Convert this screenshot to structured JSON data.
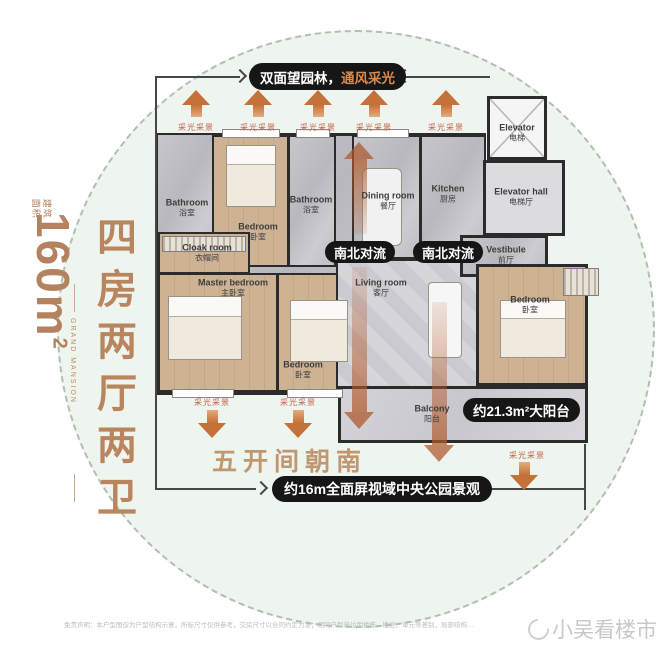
{
  "banner_top": {
    "white": "双面望园林，",
    "orange": "通风采光"
  },
  "side": {
    "area_stamp": "建筑面积",
    "area_value": "160m",
    "area_exp": "2",
    "brand": "GRAND MANSION",
    "headline": "四房两厅两卫"
  },
  "pills": {
    "convection": "南北对流",
    "balcony": "约21.3m²大阳台",
    "view": "约16m全面屏视域中央公园景观"
  },
  "slogan_south": "五开间朝南",
  "light_label": "采光采景",
  "rooms": [
    {
      "en": "Bathroom",
      "cn": "浴室"
    },
    {
      "en": "Bedroom",
      "cn": "卧室"
    },
    {
      "en": "Bathroom",
      "cn": "浴室"
    },
    {
      "en": "Cloak room",
      "cn": "衣帽间"
    },
    {
      "en": "Master bedroom",
      "cn": "主卧室"
    },
    {
      "en": "Bedroom",
      "cn": "卧室"
    },
    {
      "en": "Dining room",
      "cn": "餐厅"
    },
    {
      "en": "Kitchen",
      "cn": "厨房"
    },
    {
      "en": "Elevator",
      "cn": "电梯"
    },
    {
      "en": "Elevator hall",
      "cn": "电梯厅"
    },
    {
      "en": "Vestibule",
      "cn": "前厅"
    },
    {
      "en": "Living room",
      "cn": "客厅"
    },
    {
      "en": "Bedroom",
      "cn": "卧室"
    },
    {
      "en": "Balcony",
      "cn": "阳台"
    }
  ],
  "footer": {
    "disclaimer": "免责声明：本户型图仅为户型结构示意，所标尺寸仅供参考，交房尺寸以合同约定为准；相同户型单位因楼栋、楼层、单元等差别，局部结构…",
    "watermark": "小吴看楼市"
  },
  "colors": {
    "accent_brown": "#b9855e",
    "arrow_orange": "#c4713a",
    "pill_black": "#161616",
    "pill_orange_text": "#d98a4f",
    "circle_fill": "#eef4ee",
    "label_red": "#c4604a"
  }
}
